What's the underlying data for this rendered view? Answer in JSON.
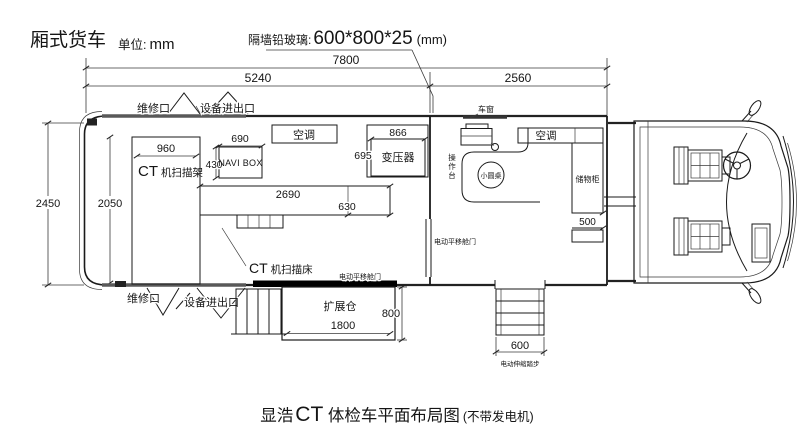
{
  "header": {
    "vehicle_type": "厢式货车",
    "unit_label": "单位:",
    "unit_value": "mm",
    "glass_label": "隔墙铅玻璃:",
    "glass_size": "600*800*25",
    "glass_suffix": "(mm)"
  },
  "dims": {
    "total": "7800",
    "rear_section": "5240",
    "front_section": "2560",
    "body_width": "2450",
    "inner_width": "2050",
    "gantry": "960",
    "navi_width": "690",
    "navi_depth": "430",
    "transformer_width": "866",
    "transformer_depth": "695",
    "bed_length": "2690",
    "bed_width": "630",
    "expansion_length": "1800",
    "expansion_height": "800",
    "cabinet_section": "500",
    "entry_width": "600"
  },
  "labels": {
    "maintenance": "维修口",
    "equipment": "设备进出口",
    "gantry_prefix": "CT",
    "gantry_name": "机扫描架",
    "bed_prefix": "CT",
    "bed_name": "机扫描床",
    "navi": "NAVI BOX",
    "ac": "空调",
    "transformer": "变压器",
    "sliding_door": "电动平移舱门",
    "expansion": "扩展仓",
    "window": "车窗",
    "console_chars": [
      "操",
      "作",
      "台"
    ],
    "round_table": "小圆桌",
    "cabinet": "储物柜",
    "retract_steps": "电动伸缩踏步"
  },
  "title": {
    "brand": "显浩",
    "model": "CT",
    "rest": " 体检车平面布局图",
    "suffix": "(不带发电机)"
  }
}
